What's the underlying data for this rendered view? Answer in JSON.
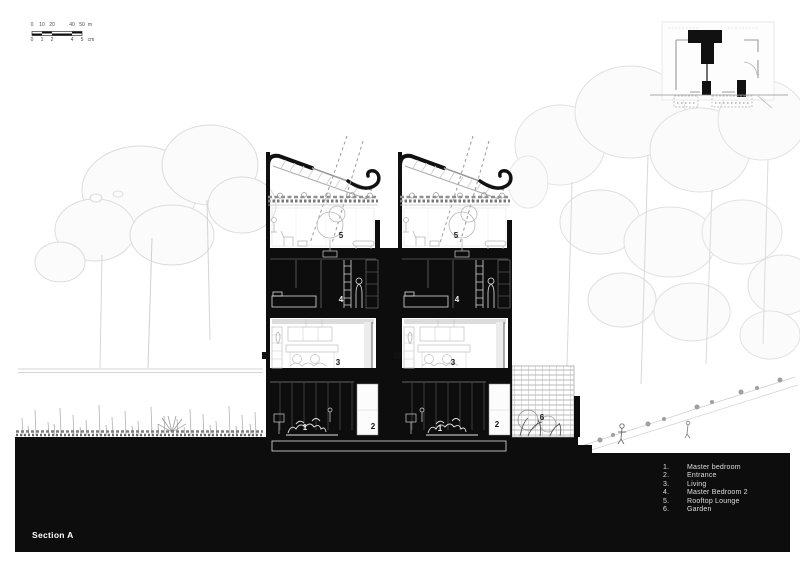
{
  "section": {
    "label": "Section A"
  },
  "scale_bar": {
    "top_ticks": [
      "0",
      "10",
      "20",
      "40",
      "50",
      "m"
    ],
    "bottom_ticks": [
      "0",
      "1",
      "2",
      "4",
      "5",
      "cm"
    ]
  },
  "legend": {
    "items": [
      {
        "number": "1.",
        "label": "Master bedroom"
      },
      {
        "number": "2.",
        "label": "Entrance"
      },
      {
        "number": "3.",
        "label": "Living"
      },
      {
        "number": "4.",
        "label": "Master Bedroom 2"
      },
      {
        "number": "5.",
        "label": "Rooftop Lounge"
      },
      {
        "number": "6.",
        "label": "Garden"
      }
    ]
  },
  "room_labels": [
    {
      "text": "5"
    },
    {
      "text": "5"
    },
    {
      "text": "4"
    },
    {
      "text": "4"
    },
    {
      "text": "3"
    },
    {
      "text": "3"
    },
    {
      "text": "1"
    },
    {
      "text": "2"
    },
    {
      "text": "1"
    },
    {
      "text": "2"
    },
    {
      "text": "6"
    }
  ],
  "colors": {
    "ink": "#0d0d0d",
    "paper": "#ffffff",
    "tree_light": "#dcdcdc",
    "sketch_gray": "#bdbdbd"
  }
}
